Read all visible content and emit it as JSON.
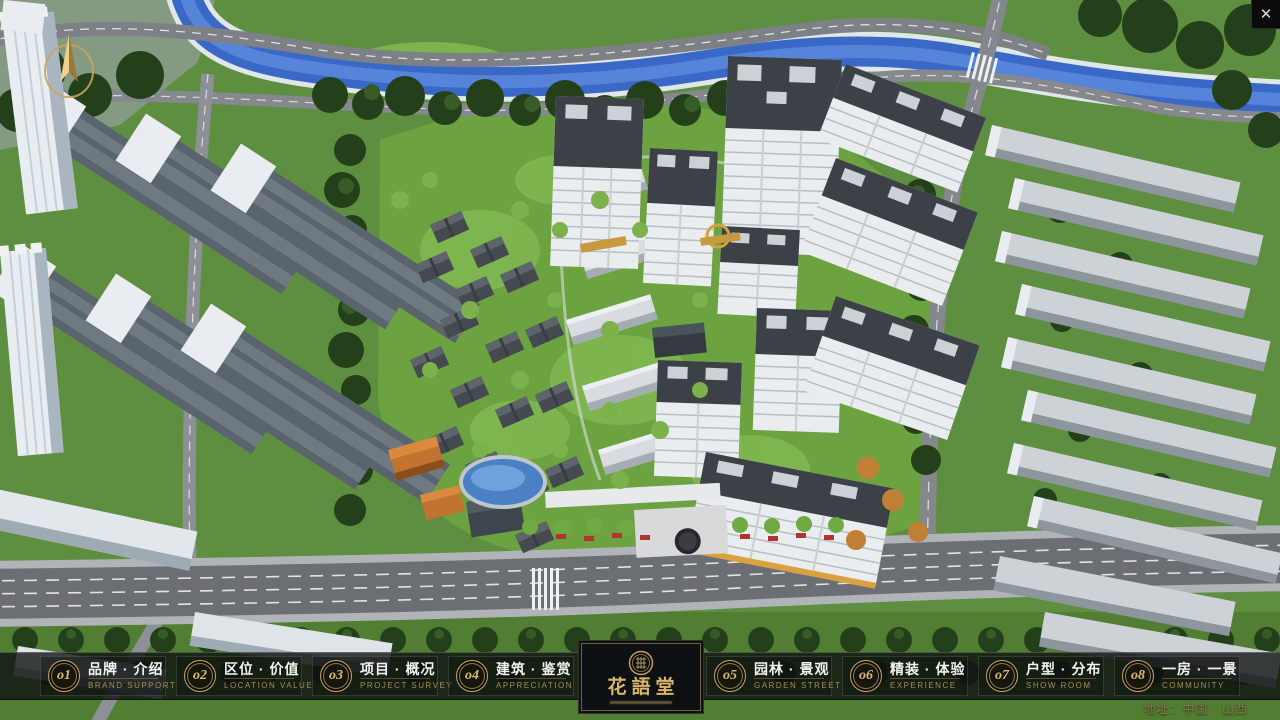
{
  "window": {
    "close_glyph": "✕"
  },
  "nav": {
    "items": [
      {
        "num": "o1",
        "cn": "品牌 · 介绍",
        "en": "BRAND SUPPORT"
      },
      {
        "num": "o2",
        "cn": "区位 · 价值",
        "en": "LOCATION VALUE"
      },
      {
        "num": "o3",
        "cn": "项目 · 概况",
        "en": "PROJECT SURVEY"
      },
      {
        "num": "o4",
        "cn": "建筑 · 鉴赏",
        "en": "APPRECIATION"
      },
      {
        "num": "o5",
        "cn": "园林 · 景观",
        "en": "GARDEN STREET"
      },
      {
        "num": "o6",
        "cn": "精装 · 体验",
        "en": "EXPERIENCE"
      },
      {
        "num": "o7",
        "cn": "户型 · 分布",
        "en": "SHOW ROOM"
      },
      {
        "num": "o8",
        "cn": "一房 · 一景",
        "en": "COMMUNITY"
      }
    ]
  },
  "logo": {
    "title": "花語堂"
  },
  "footer": {
    "address": "地址：中国 · 山西"
  },
  "colors": {
    "accent_gold": "#c8a55e",
    "nav_text": "#f2f3f1",
    "nav_sub_text": "#a78f55",
    "bar_background": "#0d100f",
    "river_blue": "#3a68c6",
    "lawn_green": "#5e8e3f"
  }
}
